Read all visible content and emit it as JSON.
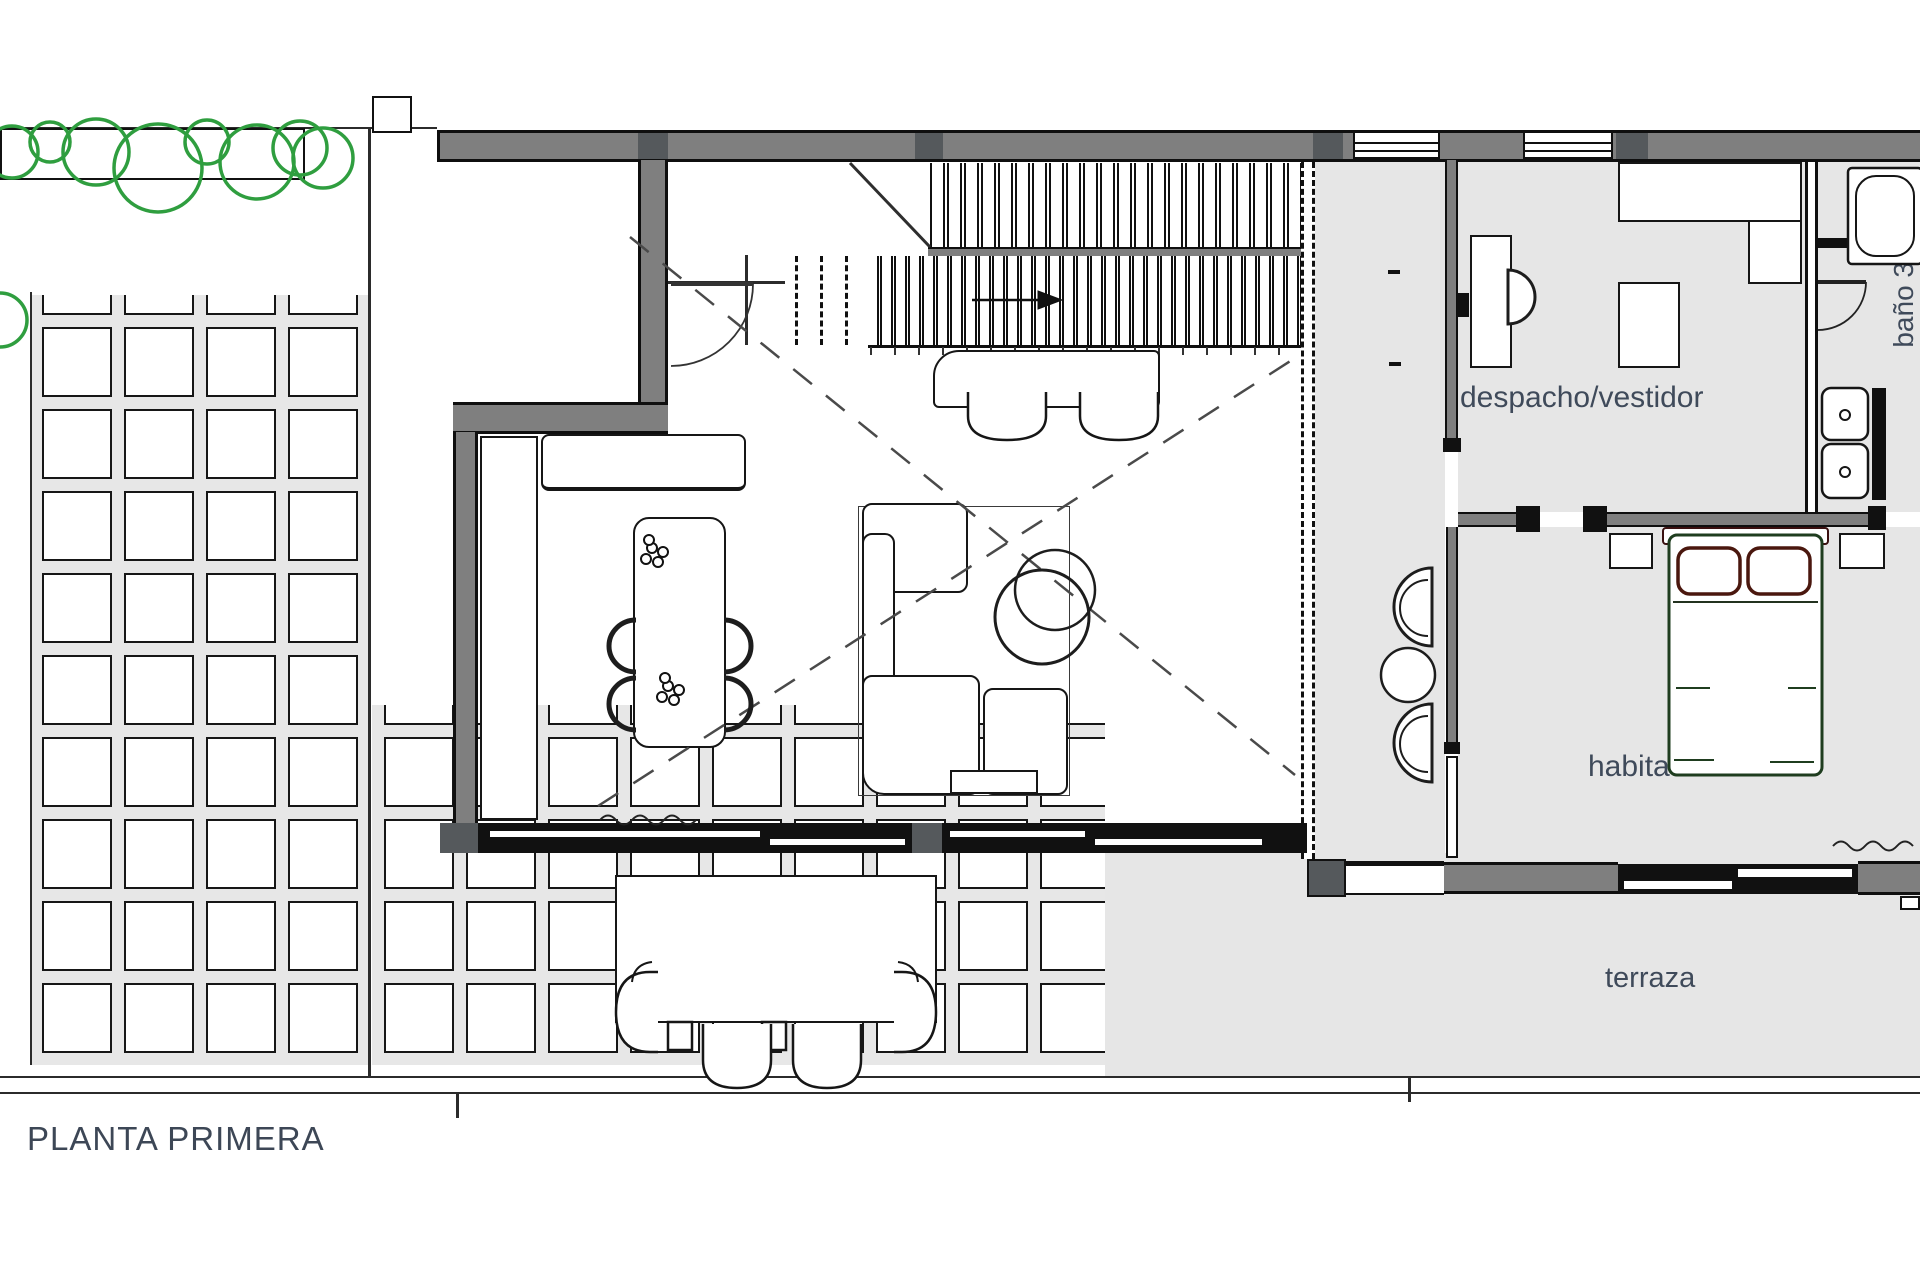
{
  "drawing": {
    "title": "PLANTA PRIMERA",
    "labels": {
      "study": "despacho/vestidor",
      "bedroom3": "habitación 3",
      "terrace": "terraza",
      "bath3": "baño 3"
    },
    "colors": {
      "wall_gray": "#7f7f7f",
      "pier_dark": "#55595c",
      "floor_gray": "#e6e6e6",
      "line_black": "#111111",
      "tree_green": "#2f9e3f",
      "label_blue": "#3f4a5a",
      "bed_frame_green": "#1f3d1f",
      "pillow_maroon": "#4a170e"
    }
  }
}
